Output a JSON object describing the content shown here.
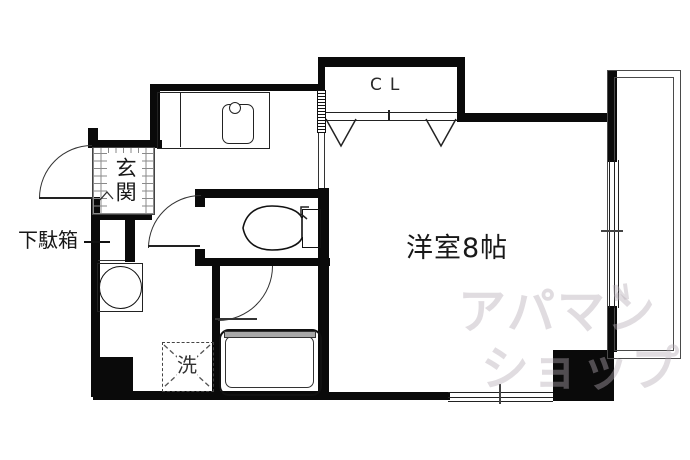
{
  "floor_plan": {
    "labels": {
      "closet": "CL",
      "main_room": "洋室8帖",
      "entrance": "玄関",
      "shoe_cabinet": "下駄箱",
      "washer": "洗"
    },
    "watermark": {
      "line1": "アパマン",
      "line2": "ショップ",
      "accent": "N"
    },
    "colors": {
      "wall": "#0a0a0a",
      "line": "#333333",
      "balcony_line": "#4a4a4a",
      "tub_rim": "#a8a8a8",
      "watermark": "rgba(180,172,180,0.42)"
    }
  }
}
